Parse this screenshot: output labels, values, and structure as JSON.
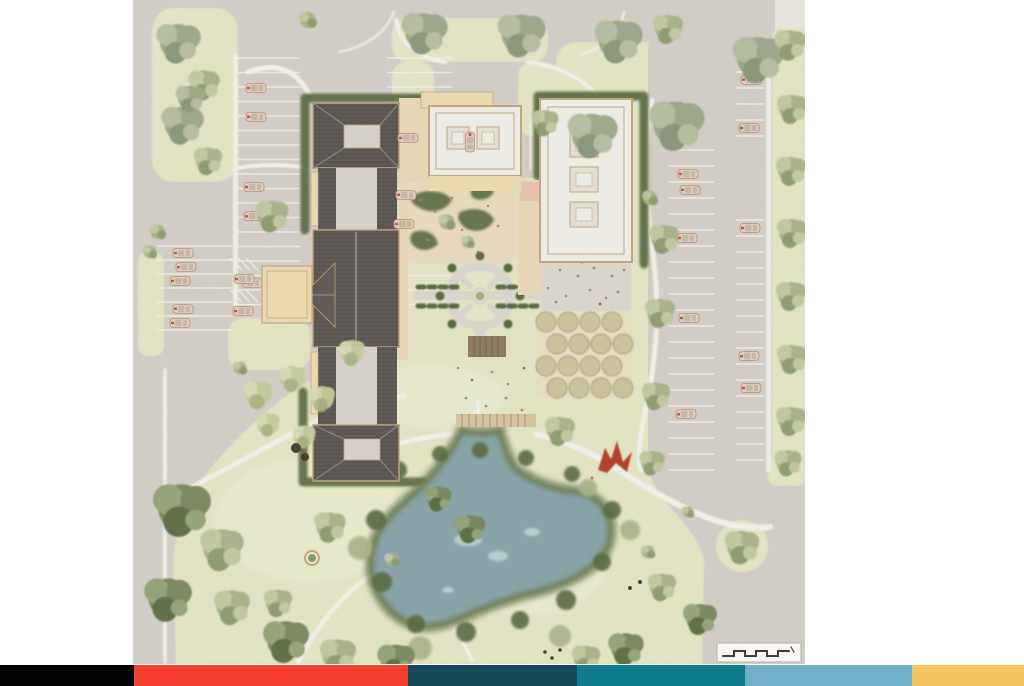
{
  "page": {
    "background": "#ffffff",
    "width_px": 1024,
    "height_px": 686
  },
  "plan": {
    "name": "watercolor-campus-site-plan",
    "left_px": 133,
    "top_px": 0,
    "width_px": 672,
    "height_px": 664,
    "colors": {
      "paving": "#d4cfc9",
      "edge_cut": "#e9e6e0",
      "path": "#f4f1ea",
      "lawn": "#e4e6c5",
      "lawn_bright": "#eef0d6",
      "sand": "#e9dcc0",
      "gravel": "#dcd8d0",
      "gravel_dot": "#b4a78c",
      "orchard": "#ccc59c",
      "orchard_rim": "#a5a476",
      "hedge": "#5a6a3f",
      "tree_gray": "#9ba687",
      "tree_gray_light": "#b5bd9e",
      "tree_gray_dark": "#879478",
      "tree_med": "#a9b287",
      "tree_med_light": "#c1c99f",
      "tree_med_dark": "#8c9a6d",
      "tree_dark": "#77855c",
      "tree_dark_light": "#93a275",
      "tree_dark_deep": "#5a6a3f",
      "tree_lime": "#c6cd9c",
      "tree_lime_light": "#d9ddb3",
      "tree_lime_mid": "#aab582",
      "roof_dark": "#5e5954",
      "roof_panel": "#d8d3cc",
      "roof_ridge": "#8d867e",
      "building_white": "#f0eee9",
      "building_inner": "#e6e1d9",
      "trim": "#c3a87c",
      "canopy": "#eddcb2",
      "terrace": "#e9dab8",
      "peach": "#e9c3b0",
      "deck": "#8c7b5f",
      "deck_line": "#6f6049",
      "boardwalk": "#d9c59e",
      "pond": "#87a5a9",
      "pond_edge": "#6e7c51",
      "pond_highlight": "#bfe0da",
      "car": "#e1cfc0",
      "car_line": "#bb8e77",
      "car_glass": "#c7b9a8",
      "car_accent": "#b06048",
      "sculpture": "#b2402a",
      "speck_brown": "#a58a62",
      "speck_dark": "#4a3e2b",
      "scalebar_bg": "#fcfbf8",
      "scalebar_border": "#b9b2a8",
      "ink": "#3d3933"
    },
    "features": [
      "west-parking-lot",
      "southwest-parking-lot",
      "accessible-parking-hatch",
      "drop-off-canopy",
      "main-building-north-pavilion",
      "main-building-link-north",
      "main-building-hall",
      "main-building-link-south",
      "main-building-south-pavilion",
      "entry-court-building",
      "gallery-building",
      "sensory-garden",
      "circular-garden",
      "gravel-plaza",
      "orchard-grid",
      "garden-deck",
      "pond-boardwalk",
      "pond",
      "red-sculpture",
      "east-parking-lot",
      "top-parking-bay",
      "perimeter-tree-rows",
      "lawn-meadow",
      "scale-bar"
    ]
  },
  "scale_bar": {
    "segments": 6,
    "style": "alternating-step-bar"
  },
  "footer": {
    "top_px": 665,
    "height_px": 21,
    "stripes": [
      {
        "name": "black",
        "color": "#020202",
        "width_px": 134
      },
      {
        "name": "red",
        "color": "#f5402f",
        "width_px": 274
      },
      {
        "name": "deep-teal",
        "color": "#15495a",
        "width_px": 169
      },
      {
        "name": "teal",
        "color": "#0d7d8b",
        "width_px": 168
      },
      {
        "name": "sky-blue",
        "color": "#73aec9",
        "width_px": 167
      },
      {
        "name": "amber",
        "color": "#f3c55f",
        "width_px": 112
      }
    ]
  }
}
